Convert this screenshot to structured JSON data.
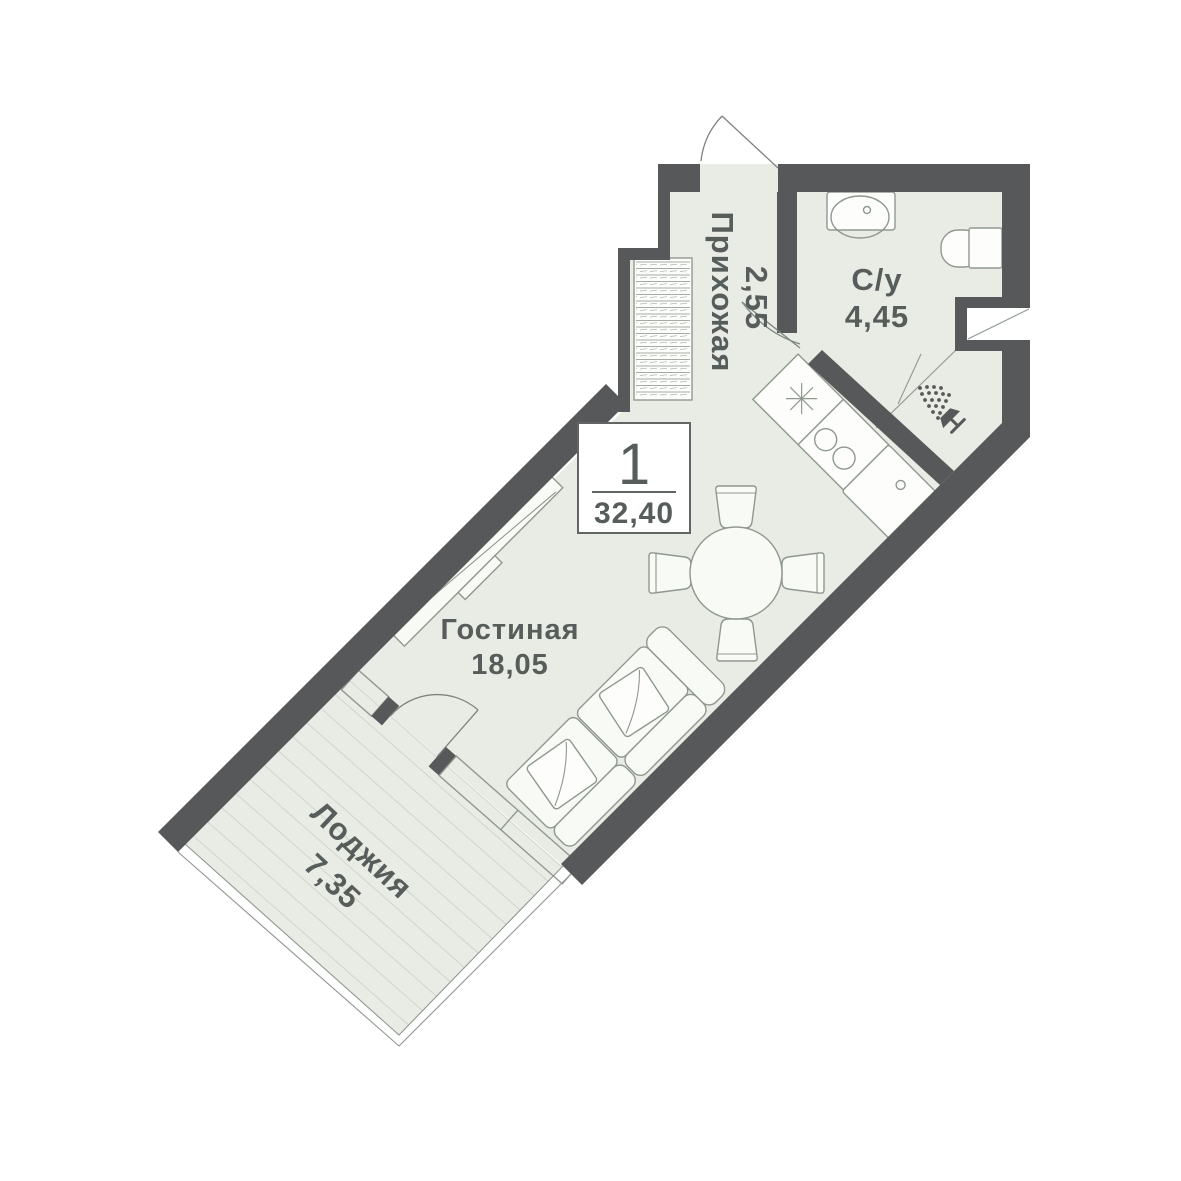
{
  "plan": {
    "rooms_count": "1",
    "total_area": "32,40"
  },
  "rooms": [
    {
      "name": "Прихожая",
      "area": "2,55"
    },
    {
      "name": "С/у",
      "area": "4,45"
    },
    {
      "name": "Гостиная",
      "area": "18,05"
    },
    {
      "name": "Лоджия",
      "area": "7,35"
    }
  ],
  "colors": {
    "wall": "#565859",
    "floor": "#e9ece5",
    "line": "#8f988f",
    "text": "#575d5a",
    "hatch": "#c6cec5",
    "white": "#ffffff"
  }
}
